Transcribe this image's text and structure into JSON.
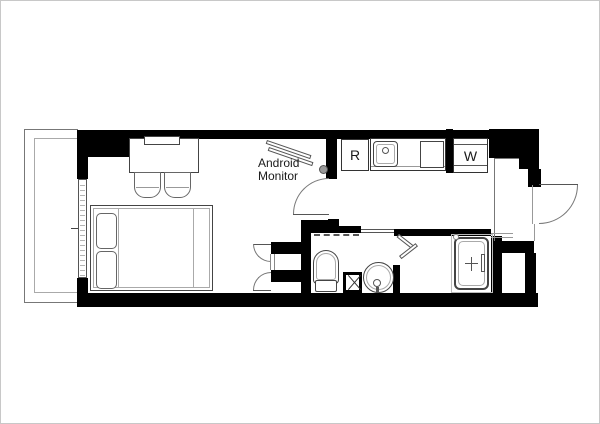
{
  "document": {
    "type": "apartment-floor-plan"
  },
  "labels": {
    "monitor_line1": "Android",
    "monitor_line2": "Monitor",
    "refrigerator": "R",
    "washer": "W"
  },
  "colors": {
    "wall": "#000000",
    "line": "#444444",
    "text": "#1a1a1a",
    "background": "#ffffff",
    "frame": "#c8c8c8"
  }
}
